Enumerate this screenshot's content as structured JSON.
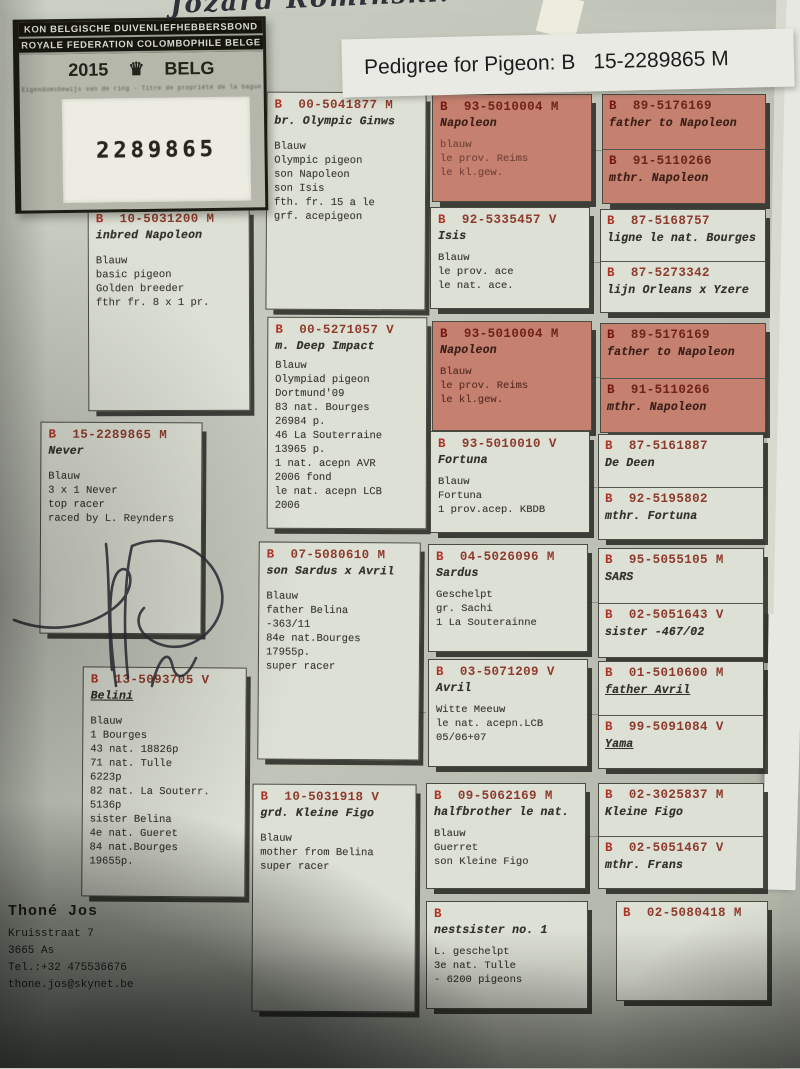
{
  "labels": {
    "prefix": "B"
  },
  "handwriting_top": "Jozard Romiński:",
  "stamp": {
    "line1": "KON BELGISCHE DUIVENLIEFHEBBERSBOND",
    "line2": "ROYALE FEDERATION COLOMBOPHILE BELGE",
    "year": "2015",
    "crown_icon": "♛",
    "country": "BELG",
    "fine_print": "Eigendomsbewijs van de ring - Titre de propriété de la bague",
    "ring_number": "2289865"
  },
  "title": {
    "label": "Pedigree for Pigeon: B",
    "ring": "15-2289865 M"
  },
  "pedigree": {
    "subject": {
      "ring": "15-2289865 M",
      "name": "Never",
      "details": "Blauw\n3 x 1 Never\ntop racer\nraced by L. Reynders"
    },
    "father": {
      "ring": "10-5031200 M",
      "name": "inbred Napoleon",
      "details": "Blauw\nbasic pigeon\nGolden breeder\nfthr fr. 8 x 1 pr."
    },
    "mother": {
      "ring": "13-5093705 V",
      "name": "Belini",
      "details": "Blauw\n1 Bourges\n43 nat. 18826p\n71 nat. Tulle\n6223p\n82 nat. La Souterr.\n5136p\nsister Belina\n4e nat. Gueret\n84 nat.Bourges\n19655p."
    },
    "grandparents": [
      {
        "ring": "00-5041877 M",
        "name": "br. Olympic Ginws",
        "details": "Blauw\nOlympic pigeon\nson Napoleon\nson Isis\nfth. fr. 15 a le\ngrf. acepigeon"
      },
      {
        "ring": "00-5271057 V",
        "name": "m. Deep Impact",
        "details": "Blauw\nOlympiad pigeon\nDortmund'09\n83 nat. Bourges\n26984 p.\n46 La Souterraine\n13965 p.\n1 nat. acepn AVR\n2006 fond\nle nat. acepn LCB\n2006"
      },
      {
        "ring": "07-5080610 M",
        "name": "son Sardus x Avril",
        "details": "Blauw\nfather Belina\n-363/11\n84e nat.Bourges\n17955p.\nsuper racer"
      },
      {
        "ring": "10-5031918 V",
        "name": "grd. Kleine Figo",
        "details": "Blauw\nmother from Belina\nsuper racer"
      }
    ],
    "great_grandparents": [
      {
        "ring": "93-5010004 M",
        "name": "Napoleon",
        "details": "blauw\nle prov. Reims\nle kl.gew."
      },
      {
        "ring": "92-5335457 V",
        "name": "Isis",
        "details": "Blauw\nle prov. ace\nle nat. ace."
      },
      {
        "ring": "93-5010004 M",
        "name": "Napoleon",
        "details": "Blauw\nle prov. Reims\nle kl.gew."
      },
      {
        "ring": "93-5010010 V",
        "name": "Fortuna",
        "details": "Blauw\nFortuna\n1 prov.acep. KBDB"
      },
      {
        "ring": "04-5026096 M",
        "name": "Sardus",
        "details": "Geschelpt\ngr. Sachi\n1 La Souterainne"
      },
      {
        "ring": "03-5071209 V",
        "name": "Avril",
        "details": "Witte Meeuw\nle nat. acepn.LCB\n05/06+07"
      },
      {
        "ring": "09-5062169 M",
        "name": "halfbrother le nat.",
        "details": "Blauw\nGuerret\nson Kleine Figo"
      },
      {
        "ring": "",
        "name": "nestsister no. 1",
        "details": "L. geschelpt\n3e nat. Tulle\n- 6200 pigeons"
      }
    ],
    "gg_pairs": [
      {
        "top": {
          "ring": "89-5176169",
          "name": "father to Napoleon"
        },
        "bottom": {
          "ring": "91-5110266",
          "name": "mthr. Napoleon"
        }
      },
      {
        "top": {
          "ring": "87-5168757",
          "name": "ligne le nat. Bourges"
        },
        "bottom": {
          "ring": "87-5273342",
          "name": "lijn Orleans x Yzere"
        }
      },
      {
        "top": {
          "ring": "89-5176169",
          "name": "father to Napoleon"
        },
        "bottom": {
          "ring": "91-5110266",
          "name": "mthr. Napoleon"
        }
      },
      {
        "top": {
          "ring": "87-5161887",
          "name": "De Deen"
        },
        "bottom": {
          "ring": "92-5195802",
          "name": "mthr. Fortuna"
        }
      },
      {
        "top": {
          "ring": "95-5055105 M",
          "name": "SARS"
        },
        "bottom": {
          "ring": "02-5051643 V",
          "name": "sister -467/02"
        }
      },
      {
        "top": {
          "ring": "01-5010600 M",
          "name": "father Avril"
        },
        "bottom": {
          "ring": "99-5091084 V",
          "name": "Yama"
        }
      },
      {
        "top": {
          "ring": "02-3025837 M",
          "name": "Kleine Figo"
        },
        "bottom": {
          "ring": "02-5051467 V",
          "name": "mthr. Frans"
        }
      },
      {
        "top": {
          "ring": "02-5080418 M",
          "name": ""
        }
      }
    ]
  },
  "owner": {
    "name": "Thoné Jos",
    "lines": "Kruisstraat 7\n3665  As\nTel.:+32 475536676\nthone.jos@skynet.be"
  },
  "colors": {
    "red_box": "#c6806f",
    "ring_text": "#8e3a2d",
    "paper": "#dde0d4"
  }
}
